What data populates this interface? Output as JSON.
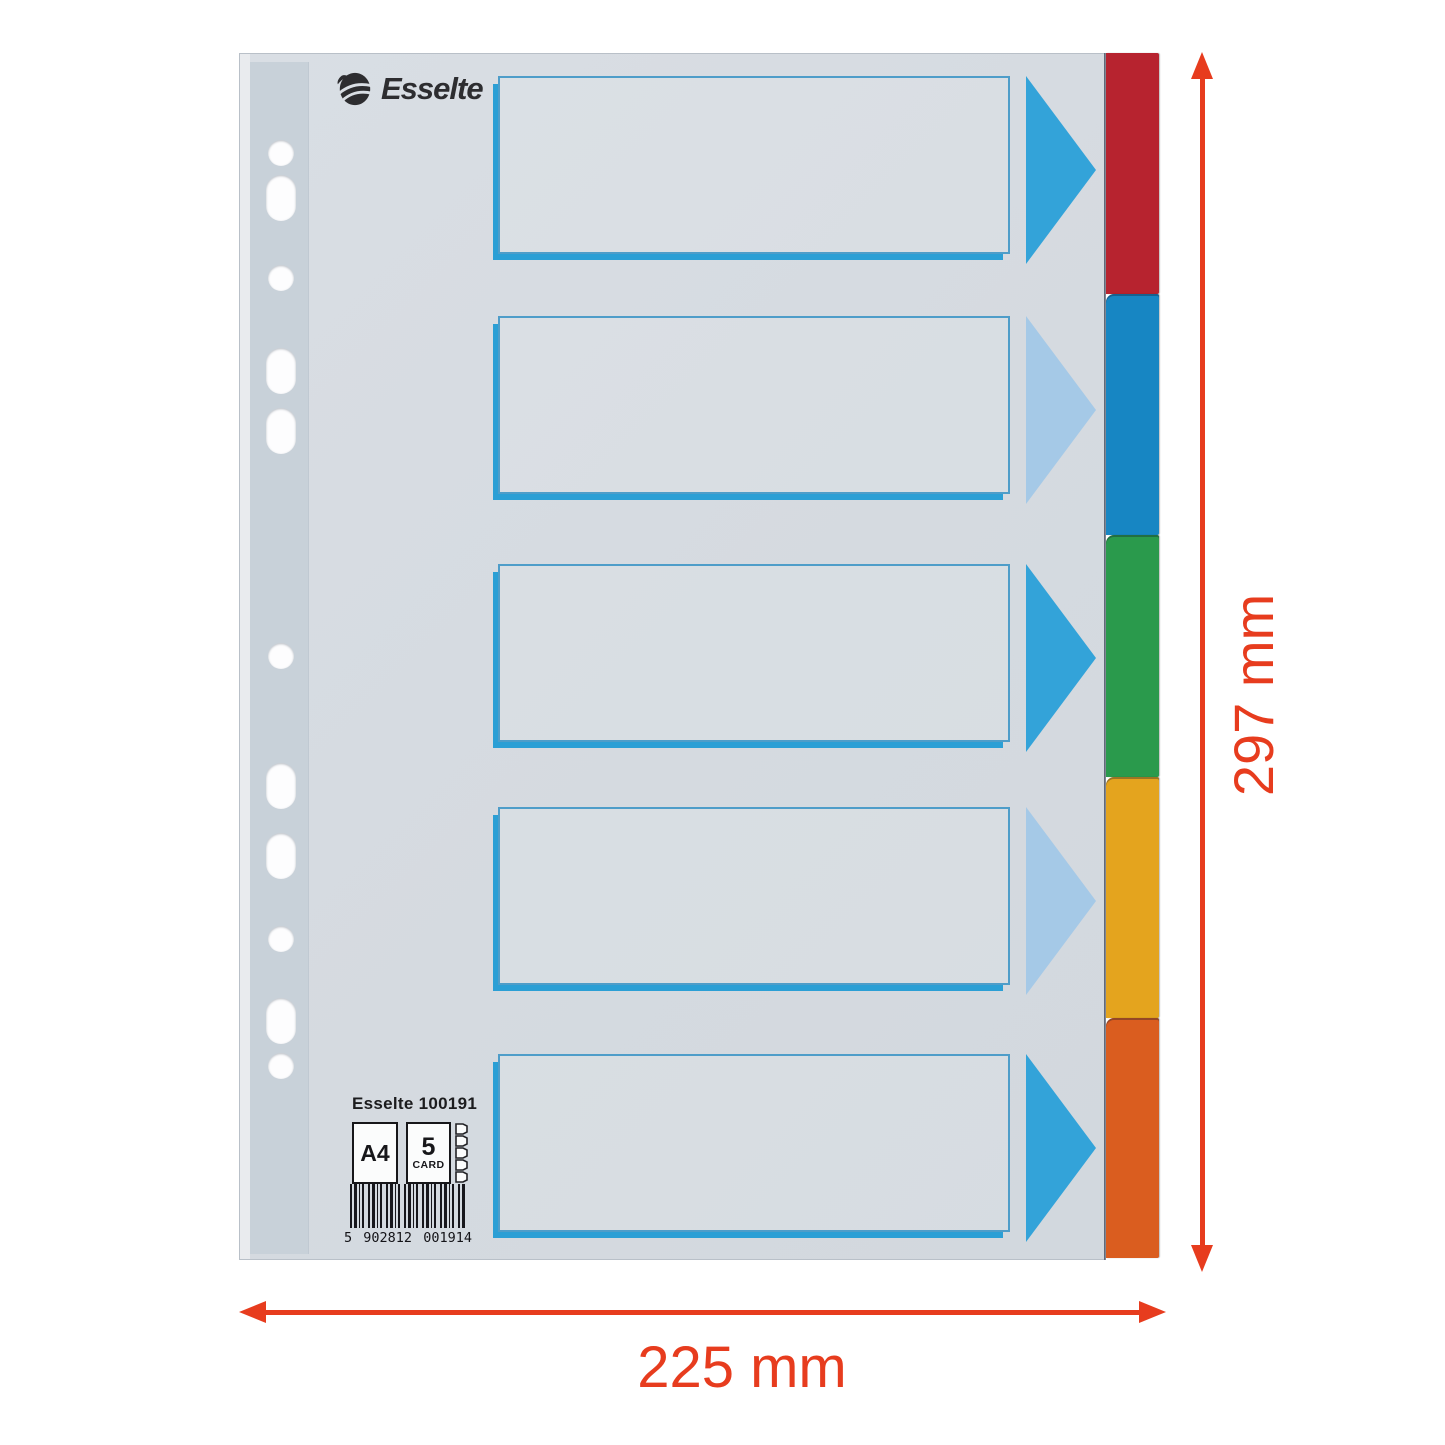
{
  "product": {
    "brand_logo": "Esselte",
    "sku_line": "Esselte 100191",
    "format_badge": "A4",
    "count_badge_number": "5",
    "count_badge_unit": "CARD",
    "barcode": {
      "prefix": "5",
      "group1": "902812",
      "group2": "001914"
    }
  },
  "dimension_annotations": {
    "height": "297 mm",
    "width": "225 mm",
    "arrow_color": "#e73c1e"
  },
  "divider": {
    "sheet_color": "#d7dce2",
    "punch_strip_color": "#c8d1d9",
    "label_box_border_color": "#4e9dc9",
    "label_box_shadow_color": "#2b9fd5",
    "hole_count": 11,
    "label_box_count": 5,
    "tabs": [
      {
        "name": "red",
        "color": "#b7232f"
      },
      {
        "name": "blue",
        "color": "#1786c3"
      },
      {
        "name": "green",
        "color": "#2a9a4c"
      },
      {
        "name": "yellow",
        "color": "#e4a41e"
      },
      {
        "name": "orange",
        "color": "#da5d1f"
      }
    ],
    "label_arrows": [
      {
        "color": "#33a3d9"
      },
      {
        "color": "#a5c9e7"
      },
      {
        "color": "#33a3d9"
      },
      {
        "color": "#a5c9e7"
      },
      {
        "color": "#33a3d9"
      }
    ]
  }
}
